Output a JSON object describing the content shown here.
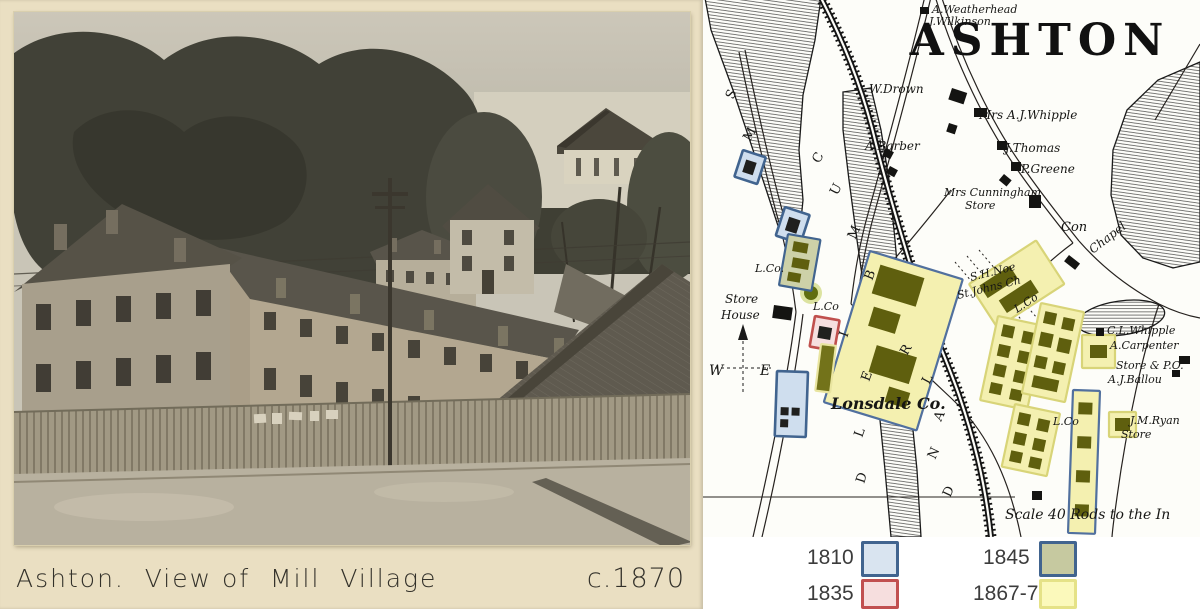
{
  "album": {
    "caption": "Ashton.  View of  Mill  Village",
    "date": "c.1870"
  },
  "map": {
    "title": "ASHTON",
    "compass": {
      "west": "W",
      "east": "E"
    },
    "colors": {
      "1810": {
        "fill": "#cfdeee",
        "stroke": "#41648f"
      },
      "1835": {
        "fill": "#f6dfdf",
        "stroke": "#c0504d"
      },
      "1845": {
        "fill": "#cdd1a8",
        "stroke": "#41648f"
      },
      "1867": {
        "fill": "#f4f0b0",
        "stroke": "#d8d478"
      },
      "1867blue": {
        "fill": "#f4f0b0",
        "stroke": "#51709e"
      },
      "olive": {
        "fill": "#73731a",
        "stroke": "#e9e5a0"
      },
      "inner_dark": "#20201e",
      "inner_olive": "#5f5f0e"
    },
    "labels": [
      {
        "t": "A.Weatherhead",
        "x": 229,
        "y": 13,
        "s": 11
      },
      {
        "t": "J.Wilkinson",
        "x": 226,
        "y": 25,
        "s": 11
      },
      {
        "t": "W.Drown",
        "x": 166,
        "y": 93,
        "s": 12
      },
      {
        "t": "Mrs A.J.Whipple",
        "x": 276,
        "y": 119,
        "s": 12
      },
      {
        "t": "A.Barber",
        "x": 162,
        "y": 150,
        "s": 12
      },
      {
        "t": "J.Thomas",
        "x": 302,
        "y": 152,
        "s": 12
      },
      {
        "t": "P.Greene",
        "x": 318,
        "y": 173,
        "s": 12
      },
      {
        "t": "Mrs Cunningham",
        "x": 241,
        "y": 196,
        "s": 11
      },
      {
        "t": "Store",
        "x": 262,
        "y": 209,
        "s": 11
      },
      {
        "t": "Con",
        "x": 358,
        "y": 231,
        "s": 13
      },
      {
        "t": "Chapel",
        "x": 390,
        "y": 254,
        "s": 12,
        "r": -38
      },
      {
        "t": "S.H.Noe",
        "x": 268,
        "y": 281,
        "s": 11,
        "r": -14
      },
      {
        "t": "St.Johns Ch",
        "x": 255,
        "y": 299,
        "s": 11,
        "r": -14
      },
      {
        "t": "Store",
        "x": 22,
        "y": 303,
        "s": 12
      },
      {
        "t": "House",
        "x": 18,
        "y": 319,
        "s": 12
      },
      {
        "t": "L.Co.",
        "x": 52,
        "y": 272,
        "s": 11
      },
      {
        "t": "L.Co",
        "x": 110,
        "y": 310,
        "s": 11
      },
      {
        "t": "Lonsdale Co.",
        "x": 128,
        "y": 409,
        "s": 16,
        "b": 1
      },
      {
        "t": "L.Co",
        "x": 314,
        "y": 313,
        "s": 11,
        "r": -33
      },
      {
        "t": "L.Co",
        "x": 350,
        "y": 425,
        "s": 11
      },
      {
        "t": "C.L.Whipple",
        "x": 404,
        "y": 334,
        "s": 11
      },
      {
        "t": "A.Carpenter",
        "x": 407,
        "y": 349,
        "s": 11
      },
      {
        "t": "Store & P.O.",
        "x": 413,
        "y": 369,
        "s": 11
      },
      {
        "t": "A.J.Ballou",
        "x": 405,
        "y": 383,
        "s": 11
      },
      {
        "t": "J.M.Ryan",
        "x": 427,
        "y": 424,
        "s": 11
      },
      {
        "t": "Store",
        "x": 418,
        "y": 438,
        "s": 11
      },
      {
        "t": "Scale 40 Rods to the In",
        "x": 302,
        "y": 519,
        "s": 14
      }
    ],
    "letters": [
      [
        "S",
        30,
        100,
        -65
      ],
      [
        "M",
        47,
        142,
        -60
      ],
      [
        "C",
        116,
        164,
        -60
      ],
      [
        "U",
        134,
        196,
        -62
      ],
      [
        "M",
        152,
        240,
        -65
      ],
      [
        "B",
        169,
        281,
        -68
      ],
      [
        "I",
        144,
        338,
        -70
      ],
      [
        "E",
        166,
        382,
        -70
      ],
      [
        "R",
        204,
        356,
        -60
      ],
      [
        "L",
        226,
        385,
        -62
      ],
      [
        "A",
        238,
        422,
        -65
      ],
      [
        "L",
        159,
        438,
        -70
      ],
      [
        "N",
        232,
        460,
        -65
      ],
      [
        "D",
        161,
        484,
        -72
      ],
      [
        "D",
        247,
        498,
        -65
      ]
    ],
    "parcels": [
      {
        "year": "1810",
        "x": 40,
        "y": 150,
        "w": 24,
        "h": 28,
        "rot": 18,
        "b": [
          [
            6,
            8,
            11,
            13
          ]
        ]
      },
      {
        "year": "1810",
        "x": 82,
        "y": 207,
        "w": 26,
        "h": 30,
        "rot": 18,
        "b": [
          [
            7,
            8,
            12,
            14
          ]
        ]
      },
      {
        "year": "1810",
        "x": 74,
        "y": 371,
        "w": 31,
        "h": 65,
        "rot": 2,
        "b": [
          [
            5,
            36,
            8,
            8
          ],
          [
            16,
            36,
            8,
            8
          ],
          [
            5,
            48,
            8,
            8
          ]
        ]
      },
      {
        "year": "1835",
        "x": 112,
        "y": 316,
        "w": 25,
        "h": 31,
        "rot": 10,
        "b": [
          [
            6,
            9,
            13,
            12
          ]
        ]
      },
      {
        "year": "1845",
        "x": 85,
        "y": 234,
        "w": 33,
        "h": 52,
        "rot": 10,
        "b": [
          [
            7,
            6,
            15,
            10
          ],
          [
            9,
            22,
            17,
            10
          ],
          [
            7,
            37,
            13,
            9
          ]
        ]
      },
      {
        "year": "1867blue",
        "x": 167,
        "y": 251,
        "w": 97,
        "h": 158,
        "rot": 17,
        "b": [
          [
            14,
            10,
            46,
            30
          ],
          [
            20,
            52,
            28,
            20
          ],
          [
            34,
            88,
            42,
            28
          ],
          [
            58,
            124,
            22,
            16
          ]
        ]
      },
      {
        "year": "1867",
        "x": 266,
        "y": 284,
        "w": 80,
        "h": 52,
        "rot": -33,
        "b": [
          [
            8,
            7,
            36,
            15
          ],
          [
            16,
            30,
            38,
            15
          ]
        ]
      },
      {
        "year": "1867",
        "x": 295,
        "y": 316,
        "w": 48,
        "h": 86,
        "rot": 12,
        "b": [
          [
            7,
            7,
            12,
            12
          ],
          [
            28,
            9,
            12,
            12
          ],
          [
            7,
            27,
            12,
            12
          ],
          [
            28,
            29,
            12,
            12
          ],
          [
            7,
            47,
            12,
            12
          ],
          [
            28,
            49,
            12,
            12
          ],
          [
            7,
            66,
            12,
            11
          ],
          [
            28,
            68,
            12,
            11
          ]
        ]
      },
      {
        "year": "1867",
        "x": 312,
        "y": 404,
        "w": 46,
        "h": 64,
        "rot": 12,
        "b": [
          [
            6,
            7,
            12,
            12
          ],
          [
            26,
            9,
            12,
            12
          ],
          [
            6,
            27,
            12,
            12
          ],
          [
            26,
            29,
            12,
            12
          ],
          [
            6,
            46,
            12,
            11
          ],
          [
            26,
            48,
            12,
            11
          ]
        ]
      },
      {
        "year": "1867",
        "x": 338,
        "y": 303,
        "w": 44,
        "h": 92,
        "rot": 12,
        "b": [
          [
            6,
            7,
            12,
            12
          ],
          [
            25,
            9,
            12,
            12
          ],
          [
            6,
            28,
            13,
            14
          ],
          [
            25,
            30,
            13,
            14
          ],
          [
            6,
            52,
            12,
            12
          ],
          [
            25,
            54,
            12,
            12
          ],
          [
            8,
            72,
            26,
            12
          ]
        ]
      },
      {
        "year": "1867",
        "x": 379,
        "y": 335,
        "w": 33,
        "h": 33,
        "rot": 0,
        "b": [
          [
            8,
            10,
            17,
            13
          ]
        ]
      },
      {
        "year": "1867",
        "x": 406,
        "y": 412,
        "w": 27,
        "h": 25,
        "rot": 0,
        "b": [
          [
            6,
            6,
            15,
            13
          ]
        ]
      },
      {
        "year": "1867blue",
        "x": 370,
        "y": 390,
        "w": 27,
        "h": 143,
        "rot": 2,
        "b": [
          [
            6,
            12,
            14,
            12
          ],
          [
            6,
            46,
            14,
            12
          ],
          [
            6,
            80,
            14,
            12
          ],
          [
            6,
            114,
            14,
            12
          ]
        ]
      },
      {
        "year": "olive",
        "x": 118,
        "y": 344,
        "w": 15,
        "h": 47,
        "rot": 7,
        "b": []
      }
    ],
    "buildings": [
      [
        217,
        7,
        9,
        7,
        0
      ],
      [
        249,
        88,
        16,
        12,
        18
      ],
      [
        246,
        123,
        9,
        9,
        18
      ],
      [
        271,
        108,
        13,
        9,
        0
      ],
      [
        294,
        141,
        10,
        9,
        0
      ],
      [
        308,
        162,
        10,
        9,
        0
      ],
      [
        183,
        148,
        9,
        8,
        28
      ],
      [
        187,
        166,
        9,
        8,
        28
      ],
      [
        326,
        195,
        12,
        13,
        0
      ],
      [
        301,
        174,
        10,
        8,
        40
      ],
      [
        366,
        255,
        14,
        8,
        38
      ],
      [
        71,
        305,
        19,
        13,
        8
      ],
      [
        393,
        328,
        8,
        8,
        0
      ],
      [
        476,
        356,
        11,
        8,
        0
      ],
      [
        469,
        370,
        8,
        7,
        0
      ],
      [
        329,
        491,
        10,
        9,
        0
      ]
    ]
  },
  "legend": {
    "items": [
      {
        "label": "1810",
        "fill": "#d9e4f0",
        "border": "#41648f"
      },
      {
        "label": "1845",
        "fill": "#c6c9a0",
        "border": "#41648f"
      },
      {
        "label": "1835",
        "fill": "#f6dede",
        "border": "#c15050"
      },
      {
        "label": "1867-70",
        "fill": "#fbf9bb",
        "border": "#e5e287"
      }
    ]
  }
}
